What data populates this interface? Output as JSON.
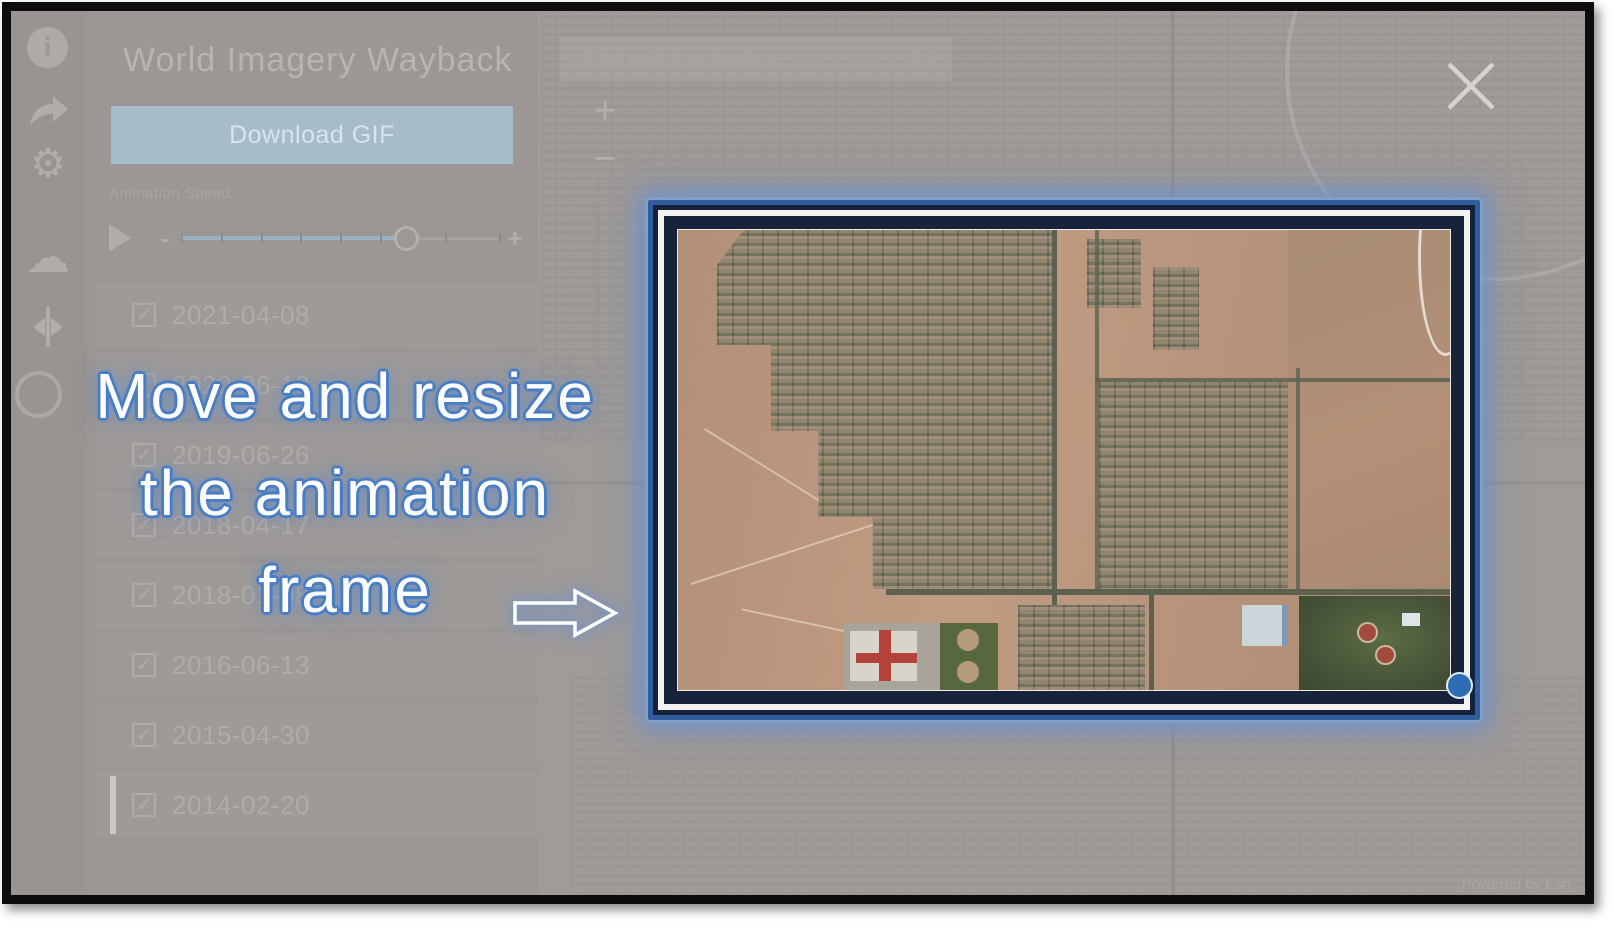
{
  "window": {
    "title": "World Imagery Wayback",
    "attribution": "Powered by Esri"
  },
  "sidebar": {
    "icons": [
      {
        "name": "info-icon",
        "glyph": "i"
      },
      {
        "name": "share-icon"
      },
      {
        "name": "settings-gear-icon",
        "glyph": "⚙"
      },
      {
        "name": "cloud-layers-icon",
        "glyph": "☁"
      },
      {
        "name": "swipe-icon"
      },
      {
        "name": "help-ring-icon"
      }
    ]
  },
  "panel": {
    "download_button_label": "Download GIF",
    "animation_speed_label": "Animation Speed",
    "slider": {
      "decrease_label": "-",
      "increase_label": "+",
      "value_percent": 71,
      "tick_count": 9
    },
    "versions": [
      {
        "date": "2021-04-08",
        "checked": true,
        "active": false
      },
      {
        "date": "2020-06-10",
        "checked": true,
        "active": false
      },
      {
        "date": "2019-06-26",
        "checked": true,
        "active": false
      },
      {
        "date": "2018-04-17",
        "checked": true,
        "active": false
      },
      {
        "date": "2018-01-08",
        "checked": true,
        "active": false
      },
      {
        "date": "2016-06-13",
        "checked": true,
        "active": false
      },
      {
        "date": "2015-04-30",
        "checked": true,
        "active": false
      },
      {
        "date": "2014-02-20",
        "checked": true,
        "active": true
      }
    ]
  },
  "map": {
    "search_placeholder": "Find address or place",
    "zoom_in_label": "+",
    "zoom_out_label": "−"
  },
  "tutorial": {
    "instruction_line1": "Move and resize",
    "instruction_line2": "the animation",
    "instruction_line3": "frame"
  },
  "colors": {
    "frame_border_blue": "#2f5d9f",
    "handle_blue": "#2e6cb4",
    "glow_blue": "#6f9bd4",
    "instruction_outline_blue": "#4a7ec4",
    "download_button_bg": "#a6bcca",
    "dimmed_background": "#a09a98"
  }
}
